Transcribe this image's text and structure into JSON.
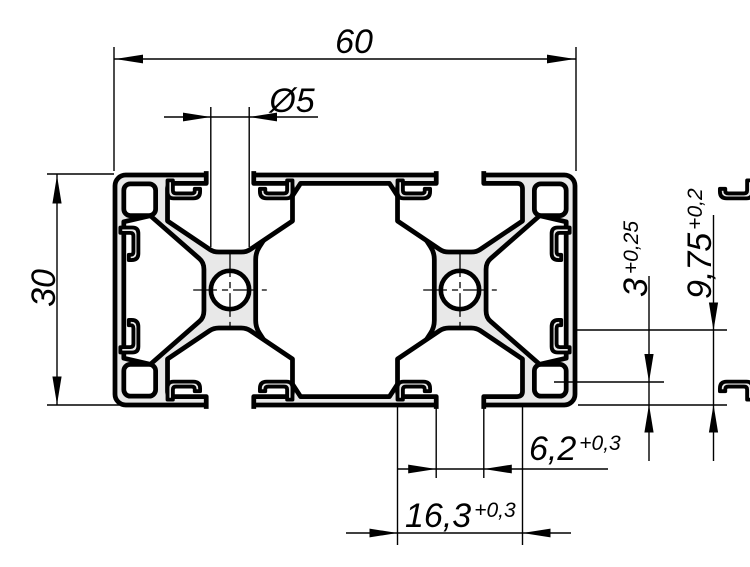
{
  "drawing": {
    "type": "technical-cross-section",
    "dimensions": {
      "width": {
        "value": "60"
      },
      "height": {
        "value": "30"
      },
      "hole": {
        "value": "Ø5"
      },
      "slot_depth": {
        "value": "9,75",
        "tol": "+0,2"
      },
      "lip_height": {
        "value": "3",
        "tol": "+0,25"
      },
      "slot_opening": {
        "value": "6,2",
        "tol": "+0,3"
      },
      "slot_width": {
        "value": "16,3",
        "tol": "+0,3"
      }
    },
    "colors": {
      "profile_fill": "#e8e8e8",
      "line": "#000000",
      "background": "#ffffff"
    }
  }
}
